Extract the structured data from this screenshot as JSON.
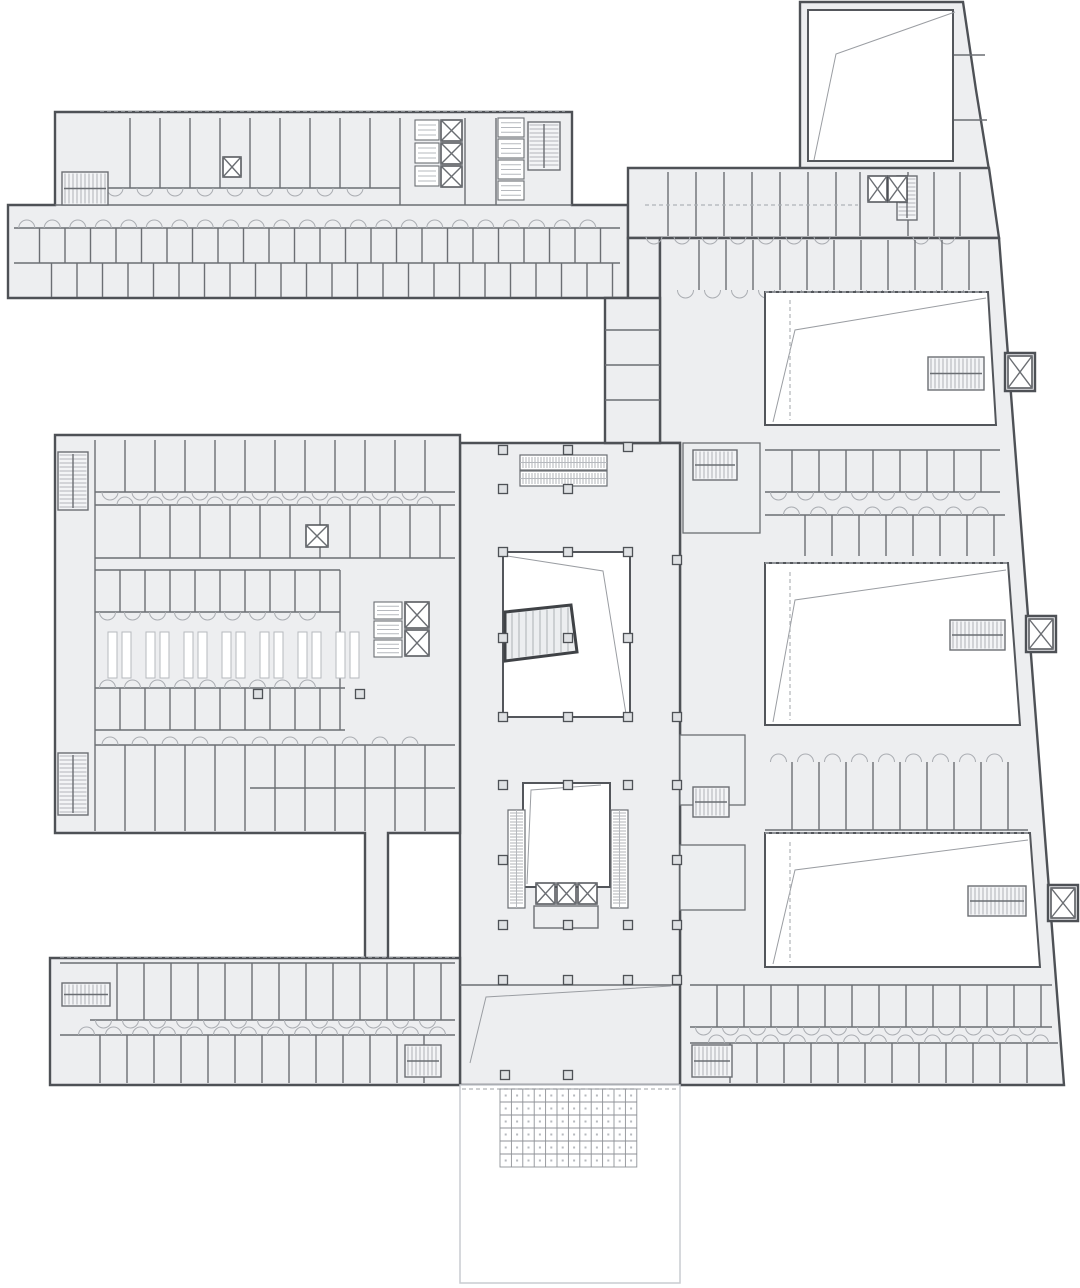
{
  "palette": {
    "paper": "#ffffff",
    "floor": "#edeef0",
    "wall": "#4e5156",
    "partition": "#6b6e73",
    "light_line": "#b6b9be",
    "void": "#ffffff"
  },
  "canvas": {
    "w": 1080,
    "h": 1288
  },
  "plan": {
    "massing": [
      {
        "name": "top-left-wing",
        "pts": [
          [
            55,
            112
          ],
          [
            572,
            112
          ],
          [
            572,
            205
          ],
          [
            628,
            205
          ],
          [
            628,
            298
          ],
          [
            8,
            298
          ],
          [
            8,
            205
          ],
          [
            55,
            205
          ]
        ]
      },
      {
        "name": "top-right-tower",
        "pts": [
          [
            800,
            2
          ],
          [
            963,
            2
          ],
          [
            976,
            90
          ],
          [
            989,
            170
          ],
          [
            800,
            170
          ]
        ]
      },
      {
        "name": "top-right-band",
        "pts": [
          [
            628,
            168
          ],
          [
            989,
            168
          ],
          [
            999,
            238
          ],
          [
            628,
            238
          ]
        ]
      },
      {
        "name": "band-stub",
        "pts": [
          [
            628,
            238
          ],
          [
            660,
            238
          ],
          [
            660,
            300
          ],
          [
            628,
            300
          ]
        ]
      },
      {
        "name": "right-wing",
        "pts": [
          [
            660,
            238
          ],
          [
            999,
            238
          ],
          [
            1064,
            1085
          ],
          [
            680,
            1085
          ],
          [
            680,
            443
          ],
          [
            660,
            443
          ]
        ]
      },
      {
        "name": "central-hall",
        "pts": [
          [
            460,
            443
          ],
          [
            680,
            443
          ],
          [
            680,
            1085
          ],
          [
            460,
            1085
          ]
        ]
      },
      {
        "name": "mid-left-block",
        "pts": [
          [
            55,
            435
          ],
          [
            460,
            435
          ],
          [
            460,
            833
          ],
          [
            388,
            833
          ],
          [
            388,
            963
          ],
          [
            365,
            963
          ],
          [
            365,
            833
          ],
          [
            55,
            833
          ]
        ]
      },
      {
        "name": "bottom-left-wing",
        "pts": [
          [
            50,
            958
          ],
          [
            460,
            958
          ],
          [
            460,
            1085
          ],
          [
            50,
            1085
          ]
        ]
      },
      {
        "name": "connector-block",
        "pts": [
          [
            605,
            298
          ],
          [
            660,
            298
          ],
          [
            660,
            443
          ],
          [
            605,
            443
          ]
        ]
      },
      {
        "name": "lift-bump-1",
        "pts": [
          [
            1005,
            353
          ],
          [
            1035,
            353
          ],
          [
            1035,
            391
          ],
          [
            1005,
            391
          ]
        ]
      },
      {
        "name": "lift-bump-2",
        "pts": [
          [
            1026,
            616
          ],
          [
            1056,
            616
          ],
          [
            1056,
            652
          ],
          [
            1026,
            652
          ]
        ]
      },
      {
        "name": "lift-bump-3",
        "pts": [
          [
            1048,
            885
          ],
          [
            1078,
            885
          ],
          [
            1078,
            921
          ],
          [
            1048,
            921
          ]
        ]
      }
    ],
    "voids": [
      {
        "name": "tower-hall",
        "pts": [
          [
            808,
            10
          ],
          [
            953,
            10
          ],
          [
            953,
            161
          ],
          [
            808,
            161
          ]
        ]
      },
      {
        "name": "auditorium-1",
        "pts": [
          [
            765,
            292
          ],
          [
            988,
            292
          ],
          [
            996,
            425
          ],
          [
            765,
            425
          ]
        ]
      },
      {
        "name": "auditorium-2",
        "pts": [
          [
            765,
            563
          ],
          [
            1008,
            563
          ],
          [
            1020,
            725
          ],
          [
            765,
            725
          ]
        ]
      },
      {
        "name": "auditorium-3",
        "pts": [
          [
            765,
            833
          ],
          [
            1030,
            833
          ],
          [
            1040,
            967
          ],
          [
            765,
            967
          ]
        ]
      },
      {
        "name": "upper-atrium",
        "pts": [
          [
            503,
            552
          ],
          [
            630,
            552
          ],
          [
            630,
            717
          ],
          [
            503,
            717
          ]
        ]
      },
      {
        "name": "lower-atrium",
        "pts": [
          [
            523,
            783
          ],
          [
            610,
            783
          ],
          [
            610,
            887
          ],
          [
            523,
            887
          ]
        ]
      }
    ],
    "plaza": {
      "x": 460,
      "y": 1085,
      "w": 220,
      "h": 198
    },
    "diagonals": [
      {
        "pts": [
          [
            955,
            12
          ],
          [
            836,
            54
          ],
          [
            814,
            160
          ]
        ]
      },
      {
        "pts": [
          [
            986,
            298
          ],
          [
            795,
            330
          ],
          [
            773,
            422
          ]
        ]
      },
      {
        "pts": [
          [
            1006,
            570
          ],
          [
            795,
            600
          ],
          [
            773,
            722
          ]
        ]
      },
      {
        "pts": [
          [
            1028,
            840
          ],
          [
            795,
            870
          ],
          [
            773,
            964
          ]
        ]
      },
      {
        "pts": [
          [
            507,
            556
          ],
          [
            603,
            571
          ],
          [
            626,
            714
          ]
        ]
      },
      {
        "pts": [
          [
            527,
            884
          ],
          [
            531,
            790
          ],
          [
            601,
            785
          ]
        ]
      },
      {
        "pts": [
          [
            470,
            1063
          ],
          [
            486,
            997
          ],
          [
            671,
            986
          ]
        ]
      }
    ],
    "dashed_lines": [
      [
        790,
        300,
        790,
        420
      ],
      [
        790,
        572,
        790,
        720
      ],
      [
        790,
        842,
        790,
        962
      ],
      [
        100,
        111,
        565,
        111
      ],
      [
        60,
        957,
        455,
        957
      ],
      [
        462,
        1089,
        678,
        1089
      ],
      [
        645,
        205,
        858,
        205
      ],
      [
        765,
        563,
        1008,
        563
      ],
      [
        765,
        833,
        1030,
        833
      ],
      [
        765,
        292,
        988,
        292
      ]
    ],
    "bands": [
      {
        "name": "tl-upper-rooms",
        "x1": 100,
        "x2": 400,
        "y1": 118,
        "y2": 188,
        "step": 30,
        "off": 0,
        "door": "b"
      },
      {
        "name": "tl-band-upper",
        "x1": 14,
        "x2": 620,
        "y1": 228,
        "y2": 263,
        "step": 25.5,
        "off": 0,
        "door": "t"
      },
      {
        "name": "tl-band-lower",
        "x1": 14,
        "x2": 620,
        "y1": 263,
        "y2": 297,
        "step": 25.5,
        "off": 12,
        "door": ""
      },
      {
        "name": "tr-band-rooms-a",
        "x1": 640,
        "x2": 862,
        "y1": 172,
        "y2": 236,
        "step": 28,
        "off": 0,
        "door": "b"
      },
      {
        "name": "tr-band-rooms-b",
        "x1": 908,
        "x2": 986,
        "y1": 172,
        "y2": 236,
        "step": 26,
        "off": 0,
        "door": "b"
      },
      {
        "name": "rw-top-row",
        "x1": 672,
        "x2": 992,
        "y1": 240,
        "y2": 290,
        "step": 27,
        "off": 0,
        "door": "b"
      },
      {
        "name": "rw-row-2a",
        "x1": 765,
        "x2": 1000,
        "y1": 450,
        "y2": 492,
        "step": 27,
        "off": 0,
        "door": "b"
      },
      {
        "name": "rw-row-2b",
        "x1": 765,
        "x2": 1005,
        "y1": 515,
        "y2": 556,
        "step": 27,
        "off": 13,
        "door": "t"
      },
      {
        "name": "rw-row-3",
        "x1": 765,
        "x2": 1028,
        "y1": 762,
        "y2": 830,
        "step": 27,
        "off": 0,
        "door": "t"
      },
      {
        "name": "rw-row-4a",
        "x1": 690,
        "x2": 1052,
        "y1": 985,
        "y2": 1027,
        "step": 27,
        "off": 0,
        "door": "b"
      },
      {
        "name": "rw-row-4b",
        "x1": 690,
        "x2": 1058,
        "y1": 1043,
        "y2": 1083,
        "step": 27,
        "off": 13,
        "door": "t"
      },
      {
        "name": "bl-row-a",
        "x1": 90,
        "x2": 455,
        "y1": 963,
        "y2": 1020,
        "step": 27,
        "off": 0,
        "door": "b"
      },
      {
        "name": "bl-row-b",
        "x1": 60,
        "x2": 455,
        "y1": 1035,
        "y2": 1083,
        "step": 27,
        "off": 13,
        "door": "t"
      },
      {
        "name": "ml-row-a",
        "x1": 95,
        "x2": 455,
        "y1": 440,
        "y2": 492,
        "step": 30,
        "off": 0,
        "door": "b"
      },
      {
        "name": "ml-row-b",
        "x1": 95,
        "x2": 455,
        "y1": 505,
        "y2": 558,
        "step": 30,
        "off": 15,
        "door": "t"
      },
      {
        "name": "ml-row-c",
        "x1": 95,
        "x2": 340,
        "y1": 570,
        "y2": 612,
        "step": 25,
        "off": 0,
        "door": "b"
      },
      {
        "name": "ml-row-d",
        "x1": 95,
        "x2": 345,
        "y1": 688,
        "y2": 730,
        "step": 25,
        "off": 0,
        "door": "t"
      },
      {
        "name": "ml-row-e",
        "x1": 95,
        "x2": 455,
        "y1": 745,
        "y2": 831,
        "step": 30,
        "off": 0,
        "door": "t"
      }
    ],
    "hwalls": [
      [
        55,
        205,
        572
      ],
      [
        14,
        228,
        620
      ],
      [
        14,
        263,
        620
      ],
      [
        100,
        188,
        400
      ],
      [
        765,
        450,
        1000
      ],
      [
        765,
        492,
        1000
      ],
      [
        765,
        515,
        1005
      ],
      [
        765,
        830,
        1028
      ],
      [
        690,
        985,
        1052
      ],
      [
        690,
        1027,
        1052
      ],
      [
        690,
        1043,
        1058
      ],
      [
        60,
        963,
        455
      ],
      [
        90,
        1020,
        455
      ],
      [
        60,
        1035,
        455
      ],
      [
        95,
        492,
        455
      ],
      [
        95,
        505,
        455
      ],
      [
        95,
        558,
        455
      ],
      [
        95,
        570,
        340
      ],
      [
        95,
        612,
        340
      ],
      [
        95,
        688,
        345
      ],
      [
        95,
        730,
        345
      ],
      [
        95,
        745,
        455
      ],
      [
        250,
        788,
        455
      ],
      [
        605,
        330,
        660
      ],
      [
        605,
        365,
        660
      ],
      [
        605,
        400,
        660
      ],
      [
        460,
        985,
        680
      ],
      [
        953,
        55,
        985
      ],
      [
        950,
        120,
        987
      ]
    ],
    "vwalls": [
      [
        400,
        118,
        205
      ],
      [
        465,
        118,
        205
      ],
      [
        496,
        118,
        205
      ],
      [
        95,
        440,
        831
      ],
      [
        340,
        570,
        730
      ],
      [
        860,
        172,
        236
      ],
      [
        908,
        172,
        236
      ],
      [
        953,
        10,
        161
      ]
    ],
    "stairs": [
      [
        62,
        172,
        46,
        33,
        "h"
      ],
      [
        528,
        122,
        32,
        48,
        "v"
      ],
      [
        897,
        176,
        20,
        44,
        "v"
      ],
      [
        693,
        450,
        44,
        30,
        "h"
      ],
      [
        928,
        357,
        56,
        33,
        "h"
      ],
      [
        950,
        620,
        55,
        30,
        "h"
      ],
      [
        968,
        886,
        58,
        30,
        "h"
      ],
      [
        692,
        1045,
        40,
        32,
        "h"
      ],
      [
        62,
        983,
        48,
        23,
        "h"
      ],
      [
        405,
        1045,
        36,
        32,
        "h"
      ],
      [
        58,
        452,
        30,
        58,
        "v"
      ],
      [
        58,
        753,
        30,
        62,
        "v"
      ],
      [
        693,
        787,
        36,
        30,
        "h"
      ]
    ],
    "escalators": [
      [
        520,
        455,
        87,
        15,
        "h"
      ],
      [
        520,
        471,
        87,
        15,
        "h"
      ],
      [
        508,
        810,
        17,
        98,
        "v"
      ],
      [
        611,
        810,
        17,
        98,
        "v"
      ]
    ],
    "elevators": [
      [
        441,
        120,
        21,
        21
      ],
      [
        441,
        143,
        21,
        21
      ],
      [
        441,
        166,
        21,
        21
      ],
      [
        868,
        176,
        19,
        26
      ],
      [
        888,
        176,
        19,
        26
      ],
      [
        306,
        525,
        22,
        22
      ],
      [
        405,
        602,
        24,
        26
      ],
      [
        405,
        630,
        24,
        26
      ],
      [
        1008,
        356,
        24,
        32
      ],
      [
        1029,
        619,
        24,
        30
      ],
      [
        1051,
        888,
        24,
        30
      ],
      [
        536,
        883,
        19,
        21
      ],
      [
        557,
        883,
        19,
        21
      ],
      [
        578,
        883,
        19,
        21
      ],
      [
        223,
        157,
        18,
        20
      ]
    ],
    "cabins": [
      [
        415,
        120,
        24,
        20
      ],
      [
        415,
        143,
        24,
        20
      ],
      [
        415,
        166,
        24,
        20
      ],
      [
        498,
        118,
        26,
        19
      ],
      [
        498,
        139,
        26,
        19
      ],
      [
        498,
        160,
        26,
        19
      ],
      [
        498,
        181,
        26,
        19
      ],
      [
        374,
        602,
        28,
        17
      ],
      [
        374,
        621,
        28,
        17
      ],
      [
        374,
        640,
        28,
        17
      ]
    ],
    "cores": [
      [
        683,
        443,
        77,
        90
      ],
      [
        680,
        735,
        65,
        70
      ],
      [
        680,
        845,
        65,
        65
      ]
    ],
    "lobby": [
      534,
      906,
      64,
      22
    ],
    "trap_stair": {
      "pts": [
        [
          505,
          612
        ],
        [
          571,
          605
        ],
        [
          577,
          652
        ],
        [
          505,
          661
        ]
      ],
      "x1": 512,
      "x2": 568,
      "step": 7
    },
    "columns": [
      [
        503,
        450
      ],
      [
        568,
        450
      ],
      [
        628,
        447
      ],
      [
        503,
        489
      ],
      [
        568,
        489
      ],
      [
        503,
        552
      ],
      [
        568,
        552
      ],
      [
        628,
        552
      ],
      [
        503,
        638
      ],
      [
        568,
        638
      ],
      [
        628,
        638
      ],
      [
        503,
        717
      ],
      [
        568,
        717
      ],
      [
        628,
        717
      ],
      [
        677,
        560
      ],
      [
        677,
        717
      ],
      [
        503,
        785
      ],
      [
        568,
        785
      ],
      [
        628,
        785
      ],
      [
        677,
        785
      ],
      [
        503,
        860
      ],
      [
        677,
        860
      ],
      [
        503,
        925
      ],
      [
        568,
        925
      ],
      [
        628,
        925
      ],
      [
        677,
        925
      ],
      [
        503,
        980
      ],
      [
        568,
        980
      ],
      [
        628,
        980
      ],
      [
        677,
        980
      ],
      [
        505,
        1075
      ],
      [
        568,
        1075
      ],
      [
        258,
        694
      ],
      [
        360,
        694
      ]
    ],
    "benches": {
      "xs": [
        108,
        146,
        184,
        222,
        260,
        298,
        336
      ],
      "y": 632,
      "w": 9,
      "h": 46,
      "gap": 14
    },
    "paver_grid": {
      "x": 500,
      "y": 1089,
      "cols": 12,
      "rows": 6,
      "cw": 11.4,
      "ch": 13
    }
  }
}
